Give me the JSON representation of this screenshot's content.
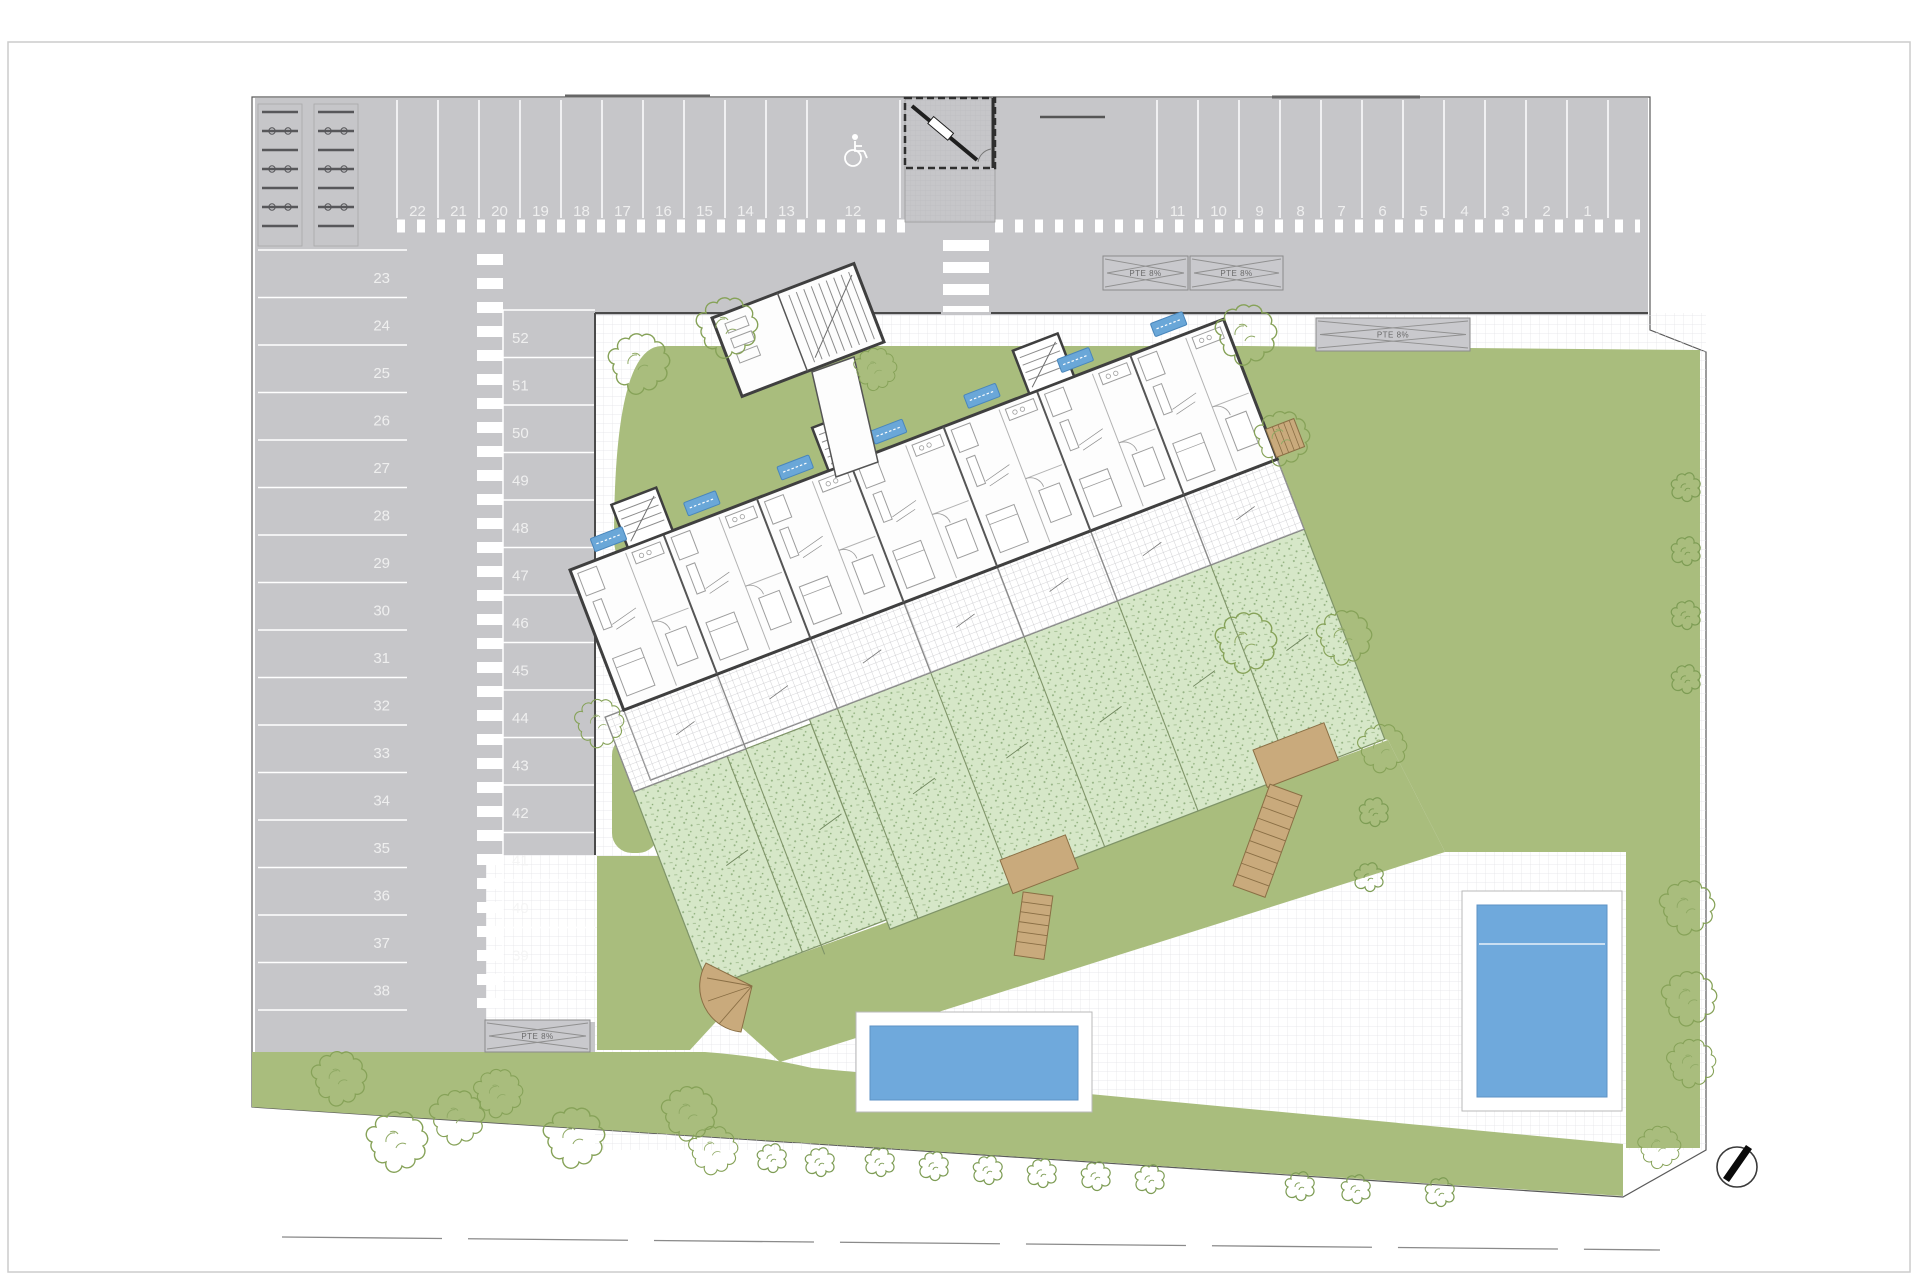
{
  "plan": {
    "parking": {
      "rows": {
        "top_left": [
          "22",
          "21",
          "20",
          "19",
          "18",
          "17",
          "16",
          "15",
          "14",
          "13",
          "12"
        ],
        "top_right": [
          "11",
          "10",
          "9",
          "8",
          "7",
          "6",
          "5",
          "4",
          "3",
          "2",
          "1"
        ],
        "west_column": [
          "23",
          "24",
          "25",
          "26",
          "27",
          "28",
          "29",
          "30",
          "31",
          "32",
          "33",
          "34",
          "35",
          "36",
          "37",
          "38"
        ],
        "inner_column": [
          "52",
          "51",
          "50",
          "49",
          "48",
          "47",
          "46",
          "45",
          "44",
          "43",
          "42",
          "41",
          "40",
          "39"
        ]
      },
      "accessible_space": "12",
      "total_spaces": 52
    },
    "ramp_label": "PTE 8%",
    "icons": {
      "accessible": "wheelchair-icon",
      "compass": "north-arrow-icon",
      "badge": "unit-entrance-badge"
    },
    "counts": {
      "unit_badges": 7,
      "pools": 2
    },
    "colors": {
      "asphalt": "#c6c6c9",
      "grass": "#a9bd7d",
      "private_garden": "#d6e7c8",
      "pool_water": "#6fa9dc",
      "wood": "#c9aa7c",
      "building_wall": "#3f3f3f",
      "badge_blue": "#6aa7d8"
    }
  }
}
